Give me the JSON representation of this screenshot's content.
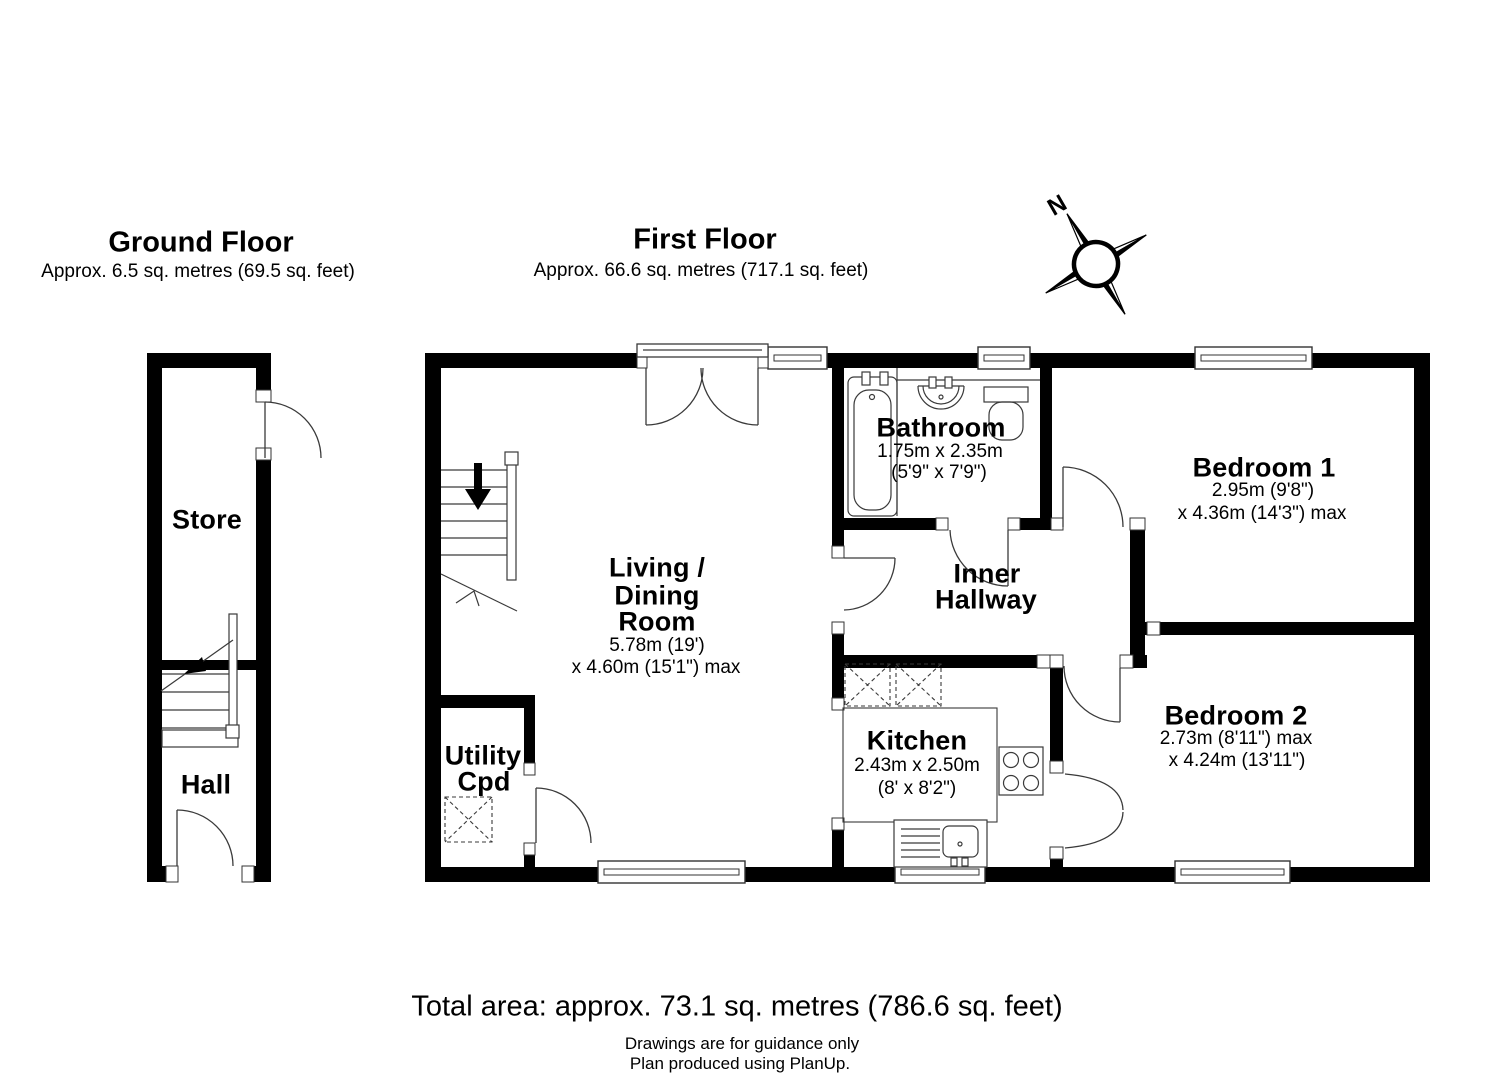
{
  "compass": {
    "north_label": "N"
  },
  "ground_floor": {
    "title": "Ground Floor",
    "area": "Approx. 6.5 sq. metres (69.5 sq. feet)",
    "rooms": {
      "store": {
        "name": "Store"
      },
      "hall": {
        "name": "Hall"
      }
    }
  },
  "first_floor": {
    "title": "First Floor",
    "area": "Approx. 66.6 sq. metres (717.1 sq. feet)",
    "rooms": {
      "living": {
        "name_lines": [
          "Living /",
          "Dining",
          "Room"
        ],
        "dims": [
          "5.78m (19')",
          "x 4.60m (15'1\") max"
        ]
      },
      "bathroom": {
        "name": "Bathroom",
        "dims": [
          "1.75m x 2.35m",
          "(5'9\" x 7'9\")"
        ]
      },
      "inner_hallway": {
        "name_lines": [
          "Inner",
          "Hallway"
        ]
      },
      "bedroom1": {
        "name": "Bedroom 1",
        "dims": [
          "2.95m (9'8\")",
          "x 4.36m (14'3\") max"
        ]
      },
      "kitchen": {
        "name": "Kitchen",
        "dims": [
          "2.43m x 2.50m",
          "(8' x 8'2\")"
        ]
      },
      "bedroom2": {
        "name": "Bedroom 2",
        "dims": [
          "2.73m (8'11\") max",
          "x 4.24m (13'11\")"
        ]
      },
      "utility": {
        "name_lines": [
          "Utility",
          "Cpd"
        ]
      }
    }
  },
  "footer": {
    "total_area": "Total area: approx. 73.1 sq. metres (786.6 sq. feet)",
    "disclaimer_line1": "Drawings are for guidance only",
    "disclaimer_line2": "Plan produced using PlanUp."
  },
  "colors": {
    "wall": "#000000",
    "background": "#ffffff",
    "line": "#3a3a3a"
  }
}
